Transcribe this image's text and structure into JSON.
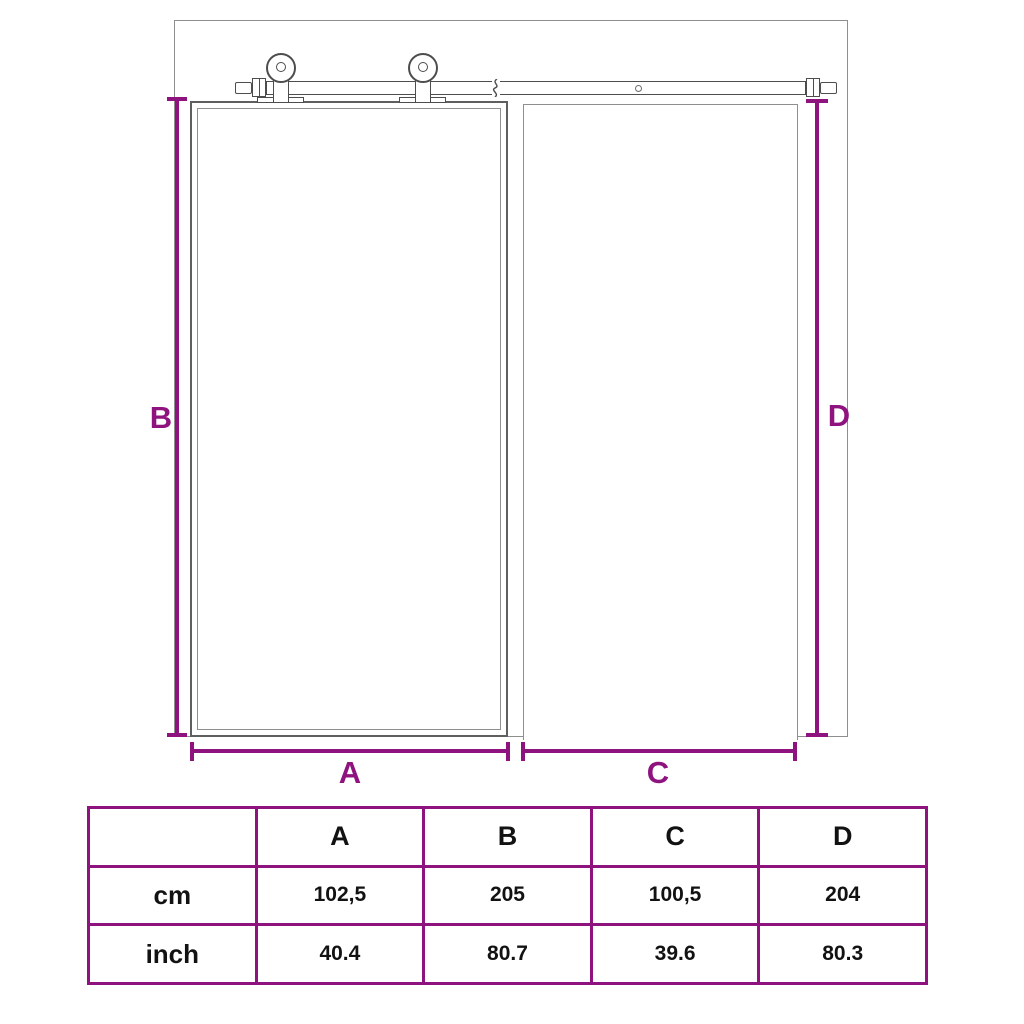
{
  "diagram": {
    "dim_labels": {
      "a": "A",
      "b": "B",
      "c": "C",
      "d": "D"
    }
  },
  "table": {
    "columns": [
      "",
      "A",
      "B",
      "C",
      "D"
    ],
    "rows": [
      {
        "label": "cm",
        "values": [
          "102,5",
          "205",
          "100,5",
          "204"
        ]
      },
      {
        "label": "inch",
        "values": [
          "40.4",
          "80.7",
          "39.6",
          "80.3"
        ]
      }
    ]
  },
  "colors": {
    "accent": "#8e137e",
    "drawing_line": "#5f5f5f"
  }
}
